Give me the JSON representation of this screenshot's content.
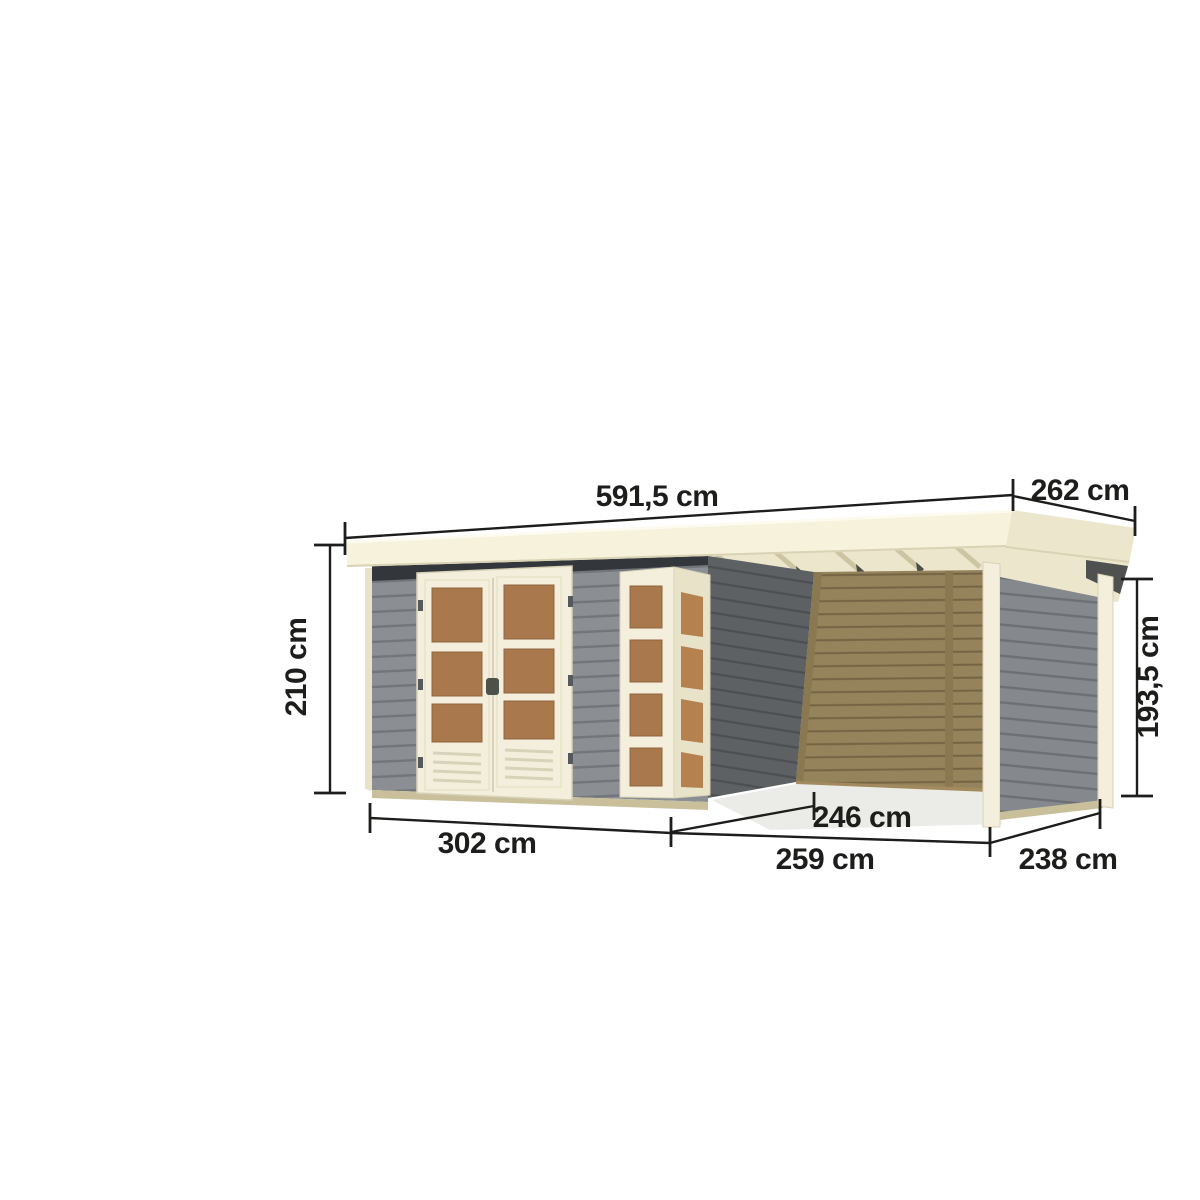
{
  "illustration": {
    "subject": "flat-roof garden shed with double glazed door, corner window element and side annex canopy",
    "unit": "cm"
  },
  "dimensions": {
    "top_width": "591,5 cm",
    "top_depth": "262 cm",
    "left_height": "210 cm",
    "right_height": "193,5 cm",
    "front_main_width": "302 cm",
    "annex_inner_depth": "246 cm",
    "annex_front_width": "259 cm",
    "right_depth": "238 cm"
  },
  "colors": {
    "background": "#ffffff",
    "line": "#1d1d1b",
    "roof_face": "#f6f2dc",
    "roof_side": "#ece6cc",
    "roof_edge": "#d9d2b4",
    "roof_highlight": "#fdfbf0",
    "cream": "#f3efdc",
    "cream_shade": "#e8e2c8",
    "cream_dark": "#d8d2b8",
    "wall_gray": "#8b8f93",
    "wall_gray_line": "#72767b",
    "wall_dark": "#5d6164",
    "wall_dark_line": "#4b4f52",
    "wall_gray2": "#85898d",
    "wall_gray2_line": "#6c7074",
    "wood": "#95835c",
    "wood_line": "#746443",
    "wood_batten": "#8a7850",
    "window_brown": "#a9784c",
    "window_brown_dark": "#8f6540",
    "window_orange": "#b5824f",
    "shadow_dark": "#33363a",
    "hardware_dark": "#4d5248",
    "hinge_gray": "#55585c",
    "plinth": "#c9c09b",
    "plinth_wood": "#a38a5e",
    "rafter": "#cdc4a2",
    "ground_shadow": "#ebebe7"
  }
}
